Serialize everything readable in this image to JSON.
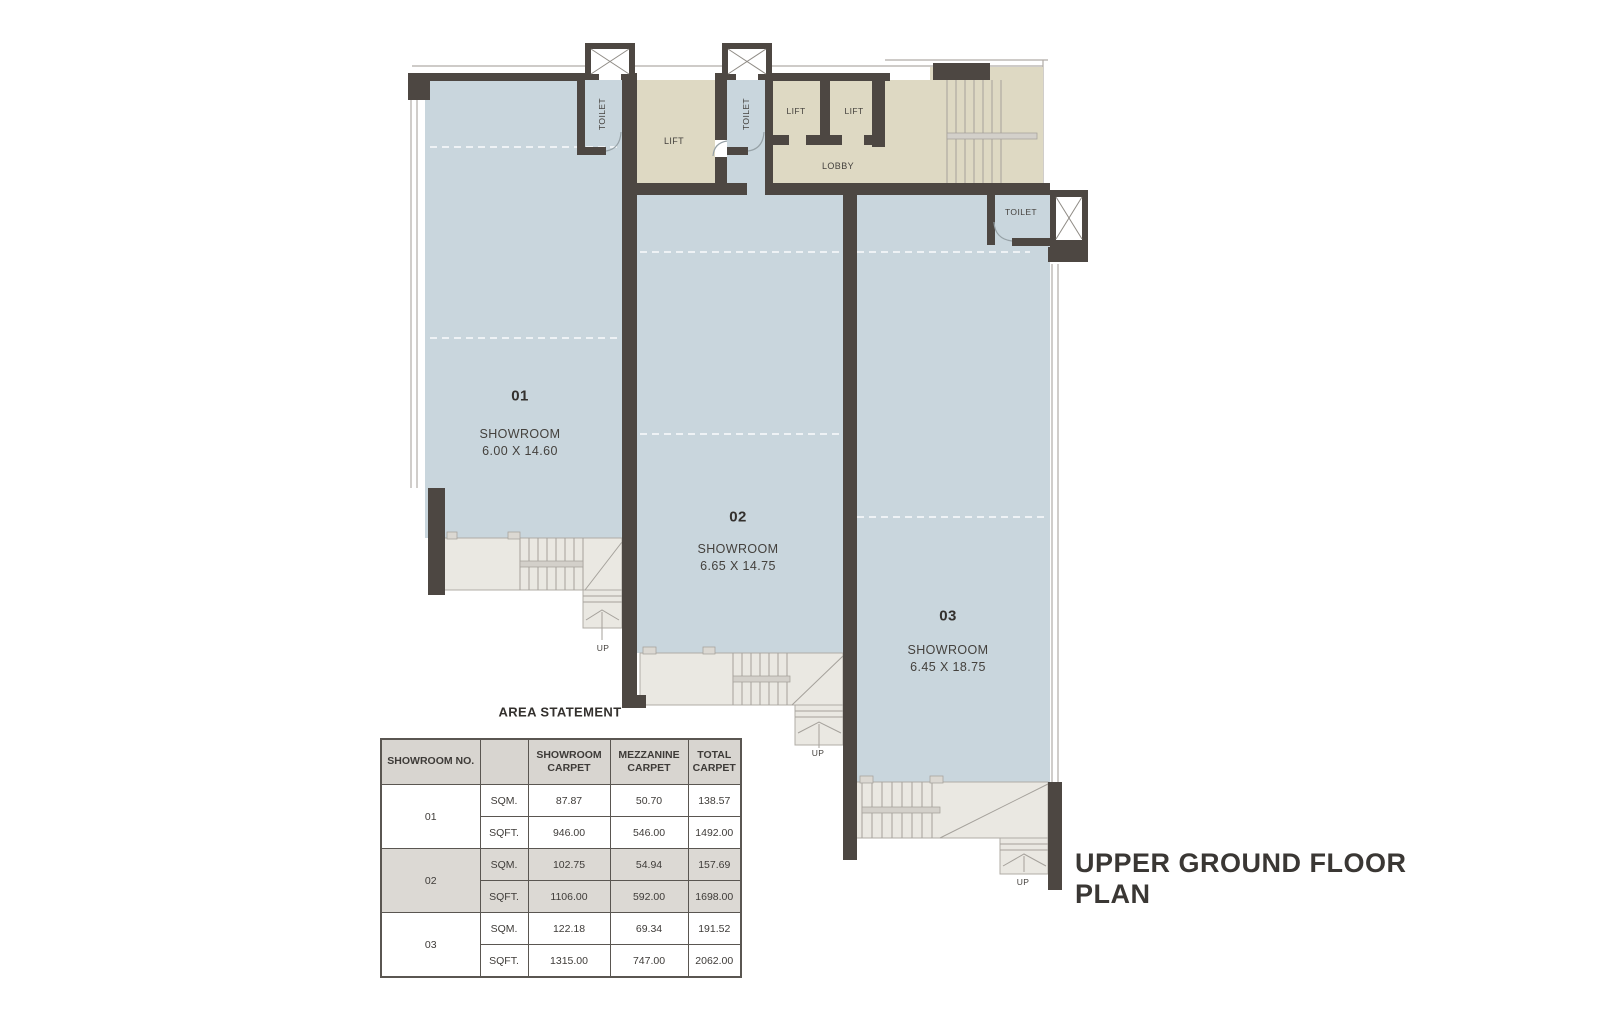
{
  "plan_title": "UPPER GROUND FLOOR PLAN",
  "area_statement": {
    "title": "AREA STATEMENT",
    "columns": [
      "SHOWROOM NO.",
      "",
      "SHOWROOM CARPET",
      "MEZZANINE CARPET",
      "TOTAL CARPET"
    ],
    "rows": [
      {
        "no": "01",
        "unit": "SQM.",
        "showroom_carpet": "87.87",
        "mezzanine_carpet": "50.70",
        "total_carpet": "138.57"
      },
      {
        "no": "",
        "unit": "SQFT.",
        "showroom_carpet": "946.00",
        "mezzanine_carpet": "546.00",
        "total_carpet": "1492.00"
      },
      {
        "no": "02",
        "unit": "SQM.",
        "showroom_carpet": "102.75",
        "mezzanine_carpet": "54.94",
        "total_carpet": "157.69"
      },
      {
        "no": "",
        "unit": "SQFT.",
        "showroom_carpet": "1106.00",
        "mezzanine_carpet": "592.00",
        "total_carpet": "1698.00"
      },
      {
        "no": "03",
        "unit": "SQM.",
        "showroom_carpet": "122.18",
        "mezzanine_carpet": "69.34",
        "total_carpet": "191.52"
      },
      {
        "no": "",
        "unit": "SQFT.",
        "showroom_carpet": "1315.00",
        "mezzanine_carpet": "747.00",
        "total_carpet": "2062.00"
      }
    ]
  },
  "rooms": {
    "showroom_01": {
      "number": "01",
      "label": "SHOWROOM",
      "dimensions": "6.00 X 14.60"
    },
    "showroom_02": {
      "number": "02",
      "label": "SHOWROOM",
      "dimensions": "6.65 X 14.75"
    },
    "showroom_03": {
      "number": "03",
      "label": "SHOWROOM",
      "dimensions": "6.45 X 18.75"
    },
    "lift_main": {
      "label": "LIFT"
    },
    "lift_a": {
      "label": "LIFT"
    },
    "lift_b": {
      "label": "LIFT"
    },
    "lobby": {
      "label": "LOBBY"
    },
    "toilet_1": {
      "label": "TOILET"
    },
    "toilet_2": {
      "label": "TOILET"
    },
    "toilet_3": {
      "label": "TOILET"
    },
    "stair_up_labels": [
      "UP",
      "UP",
      "UP"
    ]
  },
  "colors": {
    "room_fill": "#c9d6dd",
    "lobby_fill": "#ded9c3",
    "wall": "#4d4742",
    "stair_fill": "#eae8e2",
    "table_header_bg": "#d8d5d0",
    "table_alt_row_bg": "#dcd9d4",
    "text": "#3e3b38"
  }
}
